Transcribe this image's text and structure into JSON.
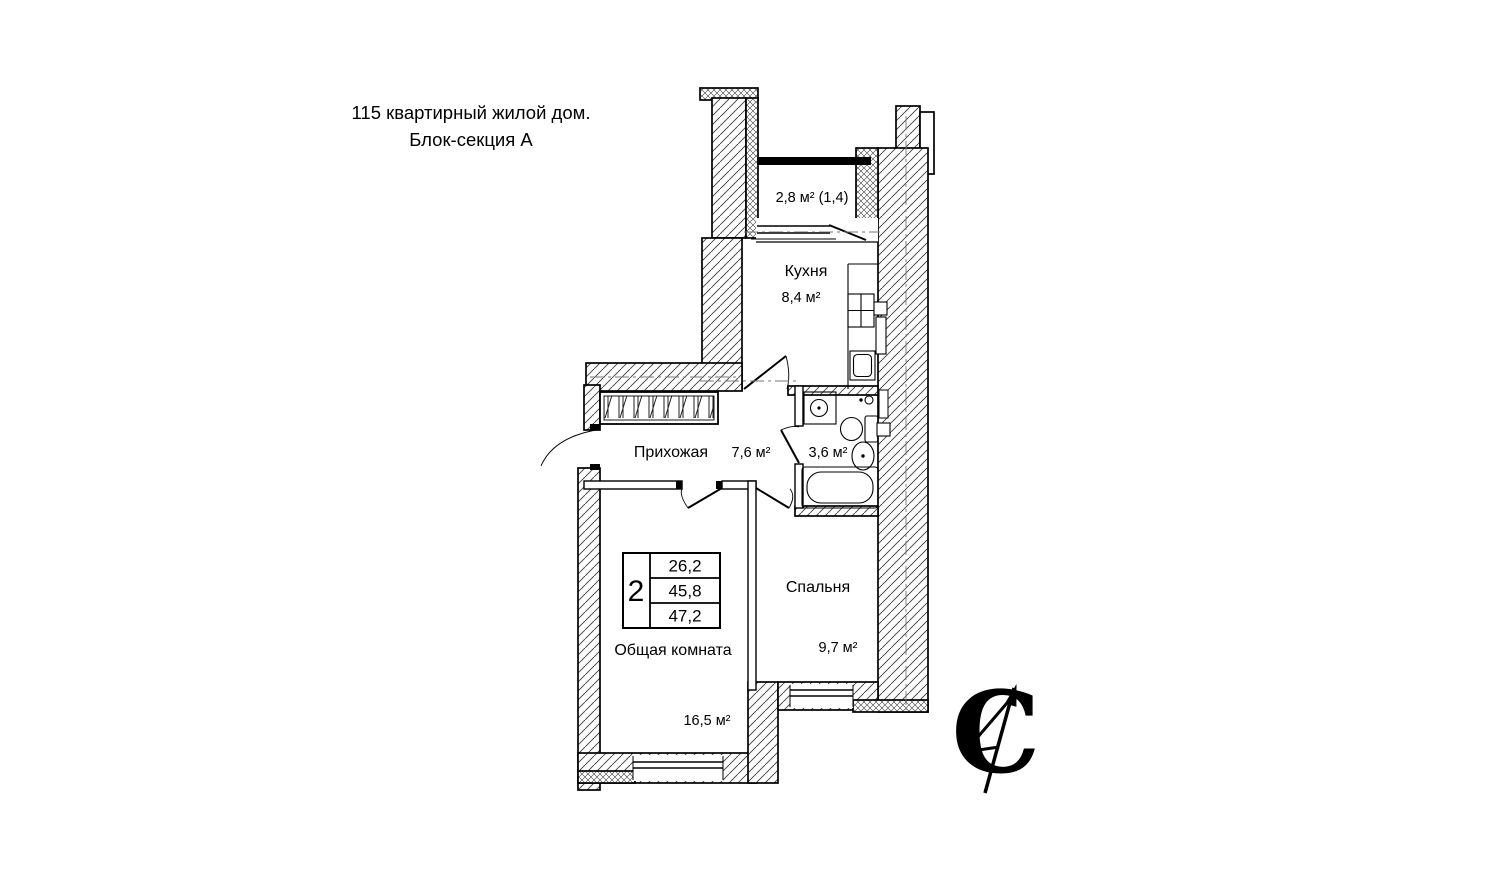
{
  "title": {
    "line1": "115 квартирный жилой дом.",
    "line2": "Блок-секция А"
  },
  "rooms": {
    "balcony": {
      "label": "2,8 м² (1,4)"
    },
    "kitchen": {
      "name": "Кухня",
      "area": "8,4 м²"
    },
    "hallway": {
      "name": "Прихожая",
      "area": "7,6 м²"
    },
    "bathroom": {
      "area": "3,6 м²"
    },
    "living_room": {
      "name": "Общая комната",
      "area": "16,5 м²"
    },
    "bedroom": {
      "name": "Спальня",
      "area": "9,7 м²"
    }
  },
  "apartment_table": {
    "rooms_count": "2",
    "values": [
      "26,2",
      "45,8",
      "47,2"
    ]
  },
  "north_symbol": {
    "letter": "С"
  },
  "colors": {
    "line": "#000000",
    "background": "#ffffff"
  }
}
